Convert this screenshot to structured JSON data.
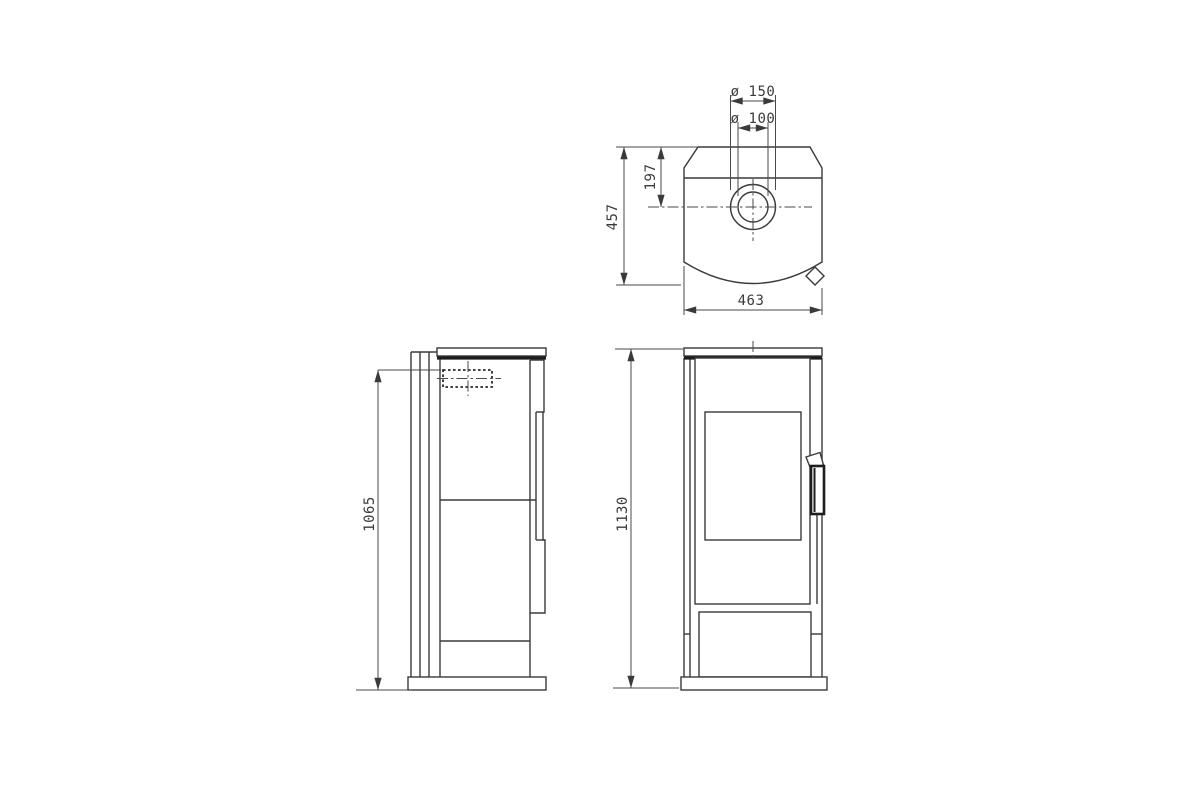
{
  "style": {
    "background": "#ffffff",
    "line_color": "#3a3a3a",
    "heavy_line_color": "#1d1d1d",
    "text_color": "#3a3a3a"
  },
  "views": {
    "top": {
      "title": "stove top view",
      "labels": {
        "dia_outer": "ø 150",
        "dia_inner": "ø 100",
        "flue_offset": "197",
        "depth": "457",
        "width": "463"
      }
    },
    "side": {
      "title": "stove side view",
      "labels": {
        "flue_height": "1065"
      }
    },
    "front": {
      "title": "stove front view",
      "labels": {
        "overall_height": "1130"
      }
    }
  }
}
